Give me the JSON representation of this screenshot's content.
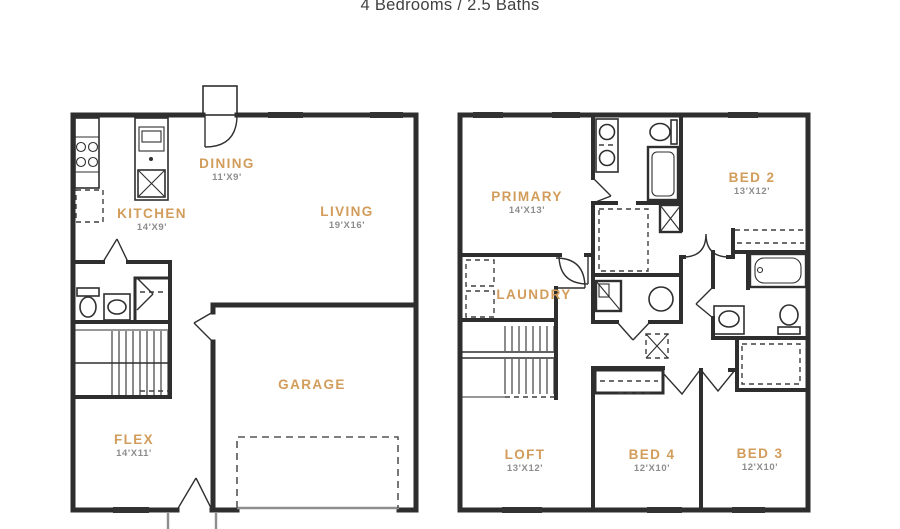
{
  "title": "4 Bedrooms / 2.5 Baths",
  "colors": {
    "room_label": "#d29c5a",
    "dimension_text": "#8d8d8d",
    "wall": "#2e2e2e",
    "title_text": "#414141",
    "window": "#333333",
    "background": "#ffffff"
  },
  "floor1": {
    "name": "First floor",
    "rooms": [
      {
        "label": "DINING",
        "dims": "11'X9'"
      },
      {
        "label": "KITCHEN",
        "dims": "14'X9'"
      },
      {
        "label": "LIVING",
        "dims": "19'X16'"
      },
      {
        "label": "GARAGE",
        "dims": ""
      },
      {
        "label": "FLEX",
        "dims": "14'X11'"
      }
    ]
  },
  "floor2": {
    "name": "Second floor",
    "rooms": [
      {
        "label": "PRIMARY",
        "dims": "14'X13'"
      },
      {
        "label": "BED 2",
        "dims": "13'X12'"
      },
      {
        "label": "LAUNDRY",
        "dims": ""
      },
      {
        "label": "LOFT",
        "dims": "13'X12'"
      },
      {
        "label": "BED 4",
        "dims": "12'X10'"
      },
      {
        "label": "BED 3",
        "dims": "12'X10'"
      }
    ]
  }
}
